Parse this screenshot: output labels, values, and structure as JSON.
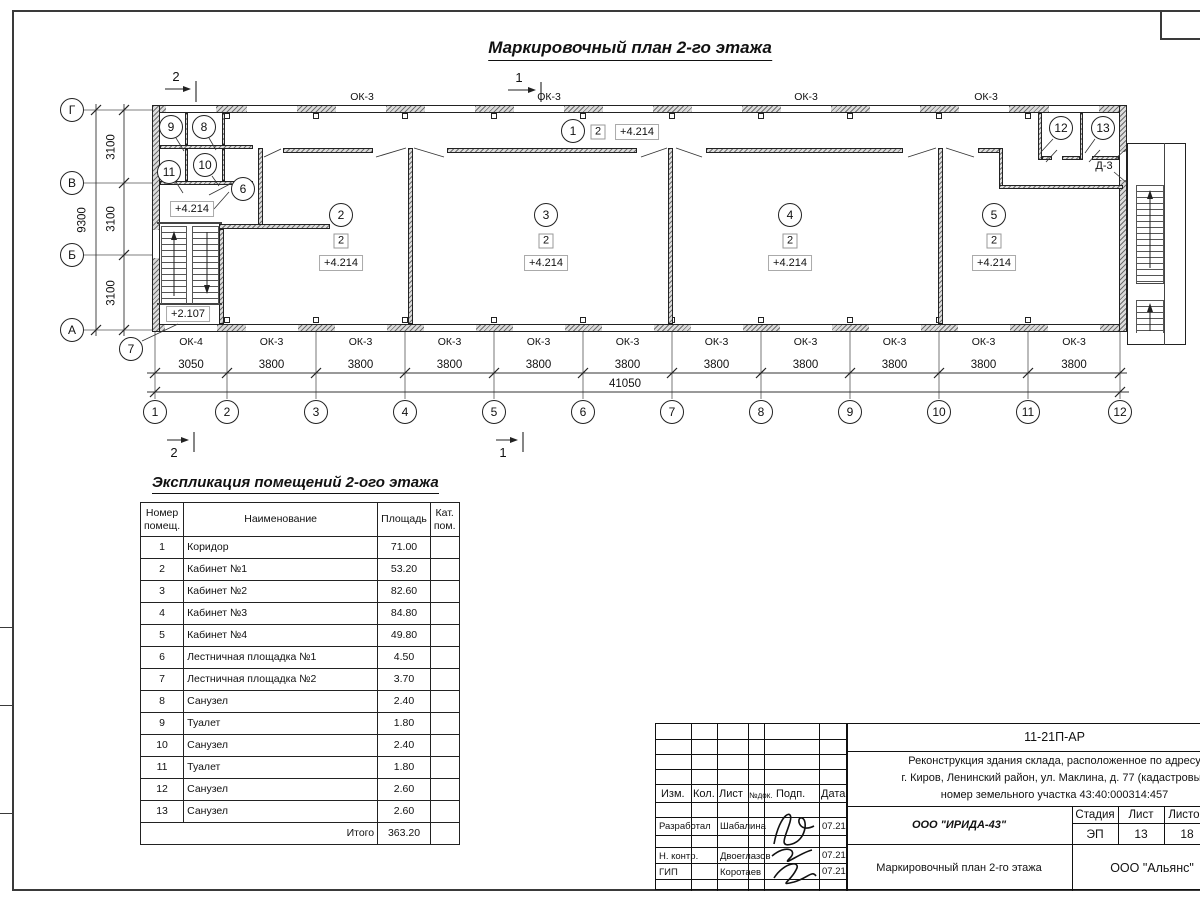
{
  "title": "Маркировочный план 2-го этажа",
  "plan": {
    "axes_h": [
      "1",
      "2",
      "3",
      "4",
      "5",
      "6",
      "7",
      "8",
      "9",
      "10",
      "11",
      "12"
    ],
    "axes_v": [
      "Г",
      "В",
      "Б",
      "А"
    ],
    "dims_bottom": [
      "3050",
      "3800",
      "3800",
      "3800",
      "3800",
      "3800",
      "3800",
      "3800",
      "3800",
      "3800",
      "3800"
    ],
    "dim_total": "41050",
    "dims_left": [
      "3100",
      "3100",
      "3100"
    ],
    "dim_left_total": "9300",
    "windows_top": [
      "ОК-3",
      "ОК-3",
      "ОК-3",
      "ОК-3"
    ],
    "windows_bottom": [
      "ОК-4",
      "ОК-3",
      "ОК-3",
      "ОК-3",
      "ОК-3",
      "ОК-3",
      "ОК-3",
      "ОК-3",
      "ОК-3",
      "ОК-3",
      "ОК-3"
    ],
    "room_numbers": [
      "1",
      "2",
      "3",
      "4",
      "5",
      "6",
      "7",
      "8",
      "9",
      "10",
      "11",
      "12",
      "13"
    ],
    "category_mark": "2",
    "elevation_main": "+4.214",
    "elevation_lower": "+2.107",
    "door_mark": "Д-3",
    "section_marks_top": [
      "2",
      "1"
    ],
    "section_marks_bottom": [
      "2",
      "1"
    ]
  },
  "schedule": {
    "title": "Экспликация помещений 2-ого этажа",
    "headers": [
      "Номер\nпомещ.",
      "Наименование",
      "Площадь",
      "Кат.\nпом."
    ],
    "rows": [
      [
        "1",
        "Коридор",
        "71.00",
        ""
      ],
      [
        "2",
        "Кабинет №1",
        "53.20",
        ""
      ],
      [
        "3",
        "Кабинет №2",
        "82.60",
        ""
      ],
      [
        "4",
        "Кабинет №3",
        "84.80",
        ""
      ],
      [
        "5",
        "Кабинет №4",
        "49.80",
        ""
      ],
      [
        "6",
        "Лестничная площадка №1",
        "4.50",
        ""
      ],
      [
        "7",
        "Лестничная площадка №2",
        "3.70",
        ""
      ],
      [
        "8",
        "Санузел",
        "2.40",
        ""
      ],
      [
        "9",
        "Туалет",
        "1.80",
        ""
      ],
      [
        "10",
        "Санузел",
        "2.40",
        ""
      ],
      [
        "11",
        "Туалет",
        "1.80",
        ""
      ],
      [
        "12",
        "Санузел",
        "2.60",
        ""
      ],
      [
        "13",
        "Санузел",
        "2.60",
        ""
      ]
    ],
    "total_label": "Итого",
    "total_value": "363.20"
  },
  "titleblock": {
    "doc_code": "11-21П-АР",
    "project_lines": [
      "Реконструкция здания склада, расположенное по адресу",
      "г. Киров, Ленинский район, ул. Маклина, д. 77 (кадастровый",
      "номер земельного участка 43:40:000314:457"
    ],
    "cols": [
      "Изм.",
      "Кол.",
      "Лист",
      "№док.",
      "Подп.",
      "Дата"
    ],
    "persons": [
      {
        "role": "Разработал",
        "name": "Шабалина",
        "date": "07.21"
      },
      {
        "role": "Н. контр.",
        "name": "Двоеглазов",
        "date": "07.21"
      },
      {
        "role": "ГИП",
        "name": "Коротаев",
        "date": "07.21"
      }
    ],
    "org": "ООО \"ИРИДА-43\"",
    "stage_headers": [
      "Стадия",
      "Лист",
      "Листов"
    ],
    "stage_values": [
      "ЭП",
      "13",
      "18"
    ],
    "sheet_title": "Маркировочный план 2-го этажа",
    "company": "ООО \"Альянс\""
  }
}
